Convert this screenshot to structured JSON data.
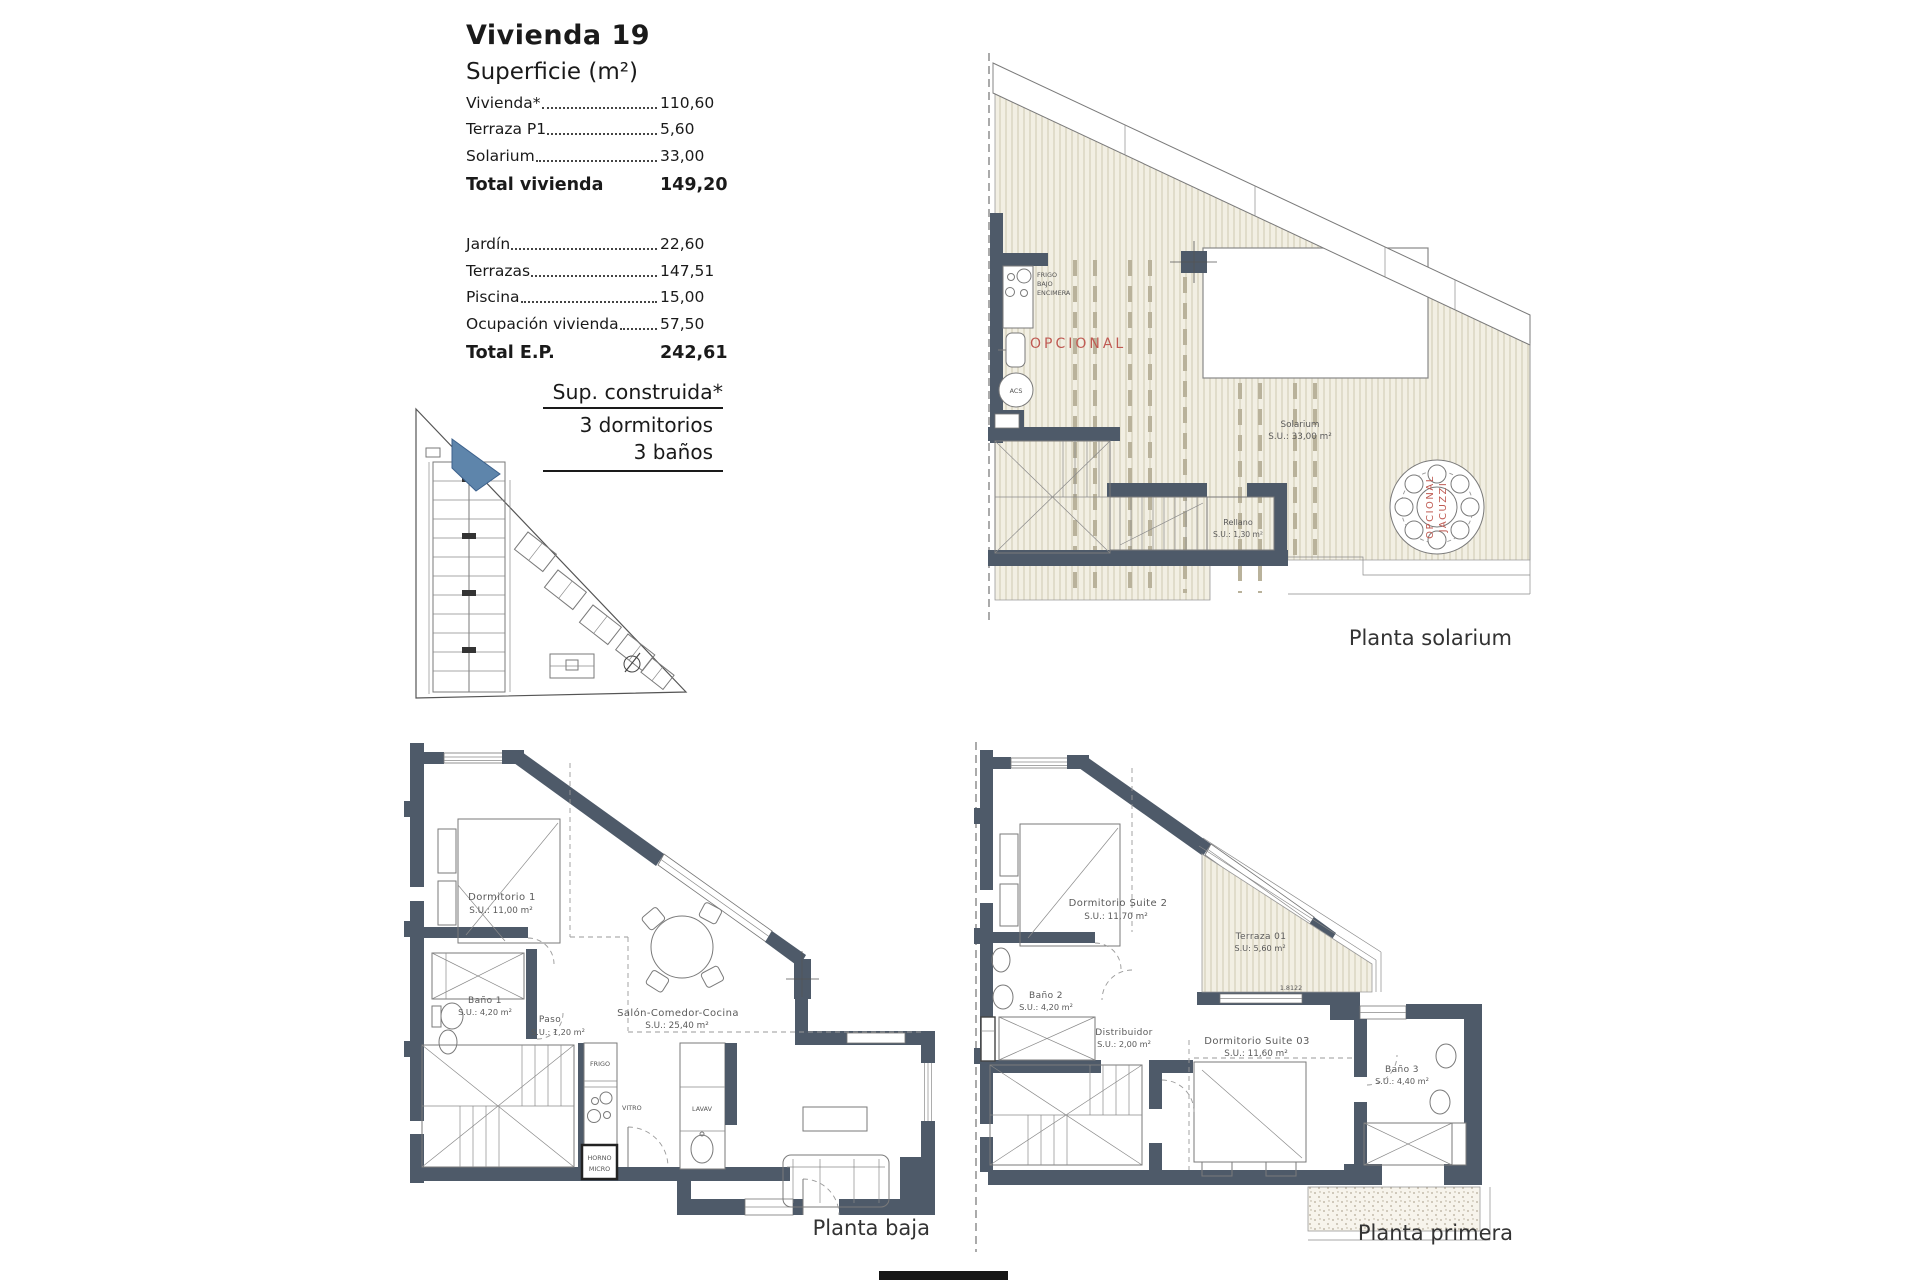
{
  "info_panel": {
    "title": "Vivienda 19",
    "subtitle": "Superficie (m²)",
    "rows": [
      {
        "label": "Vivienda*",
        "value": "110,60"
      },
      {
        "label": "Terraza P1",
        "value": "5,60"
      },
      {
        "label": "Solarium",
        "value": "33,00"
      }
    ],
    "total1": {
      "label": "Total vivienda",
      "value": "149,20"
    },
    "rows2": [
      {
        "label": "Jardín",
        "value": "22,60"
      },
      {
        "label": "Terrazas",
        "value": "147,51"
      },
      {
        "label": "Piscina",
        "value": "15,00"
      },
      {
        "label": "Ocupación vivienda",
        "value": "57,50"
      }
    ],
    "total2": {
      "label": "Total E.P.",
      "value": "242,61"
    },
    "built": {
      "line1": "Sup. construida*",
      "line2": "3 dormitorios",
      "line3": "3 baños"
    }
  },
  "colors": {
    "wall": "#4E5A69",
    "highlight_unit_blue": "#5E85AB",
    "optional_red": "#BF5A52",
    "pergola_hatch_bg": "#F2EFE3",
    "pergola_hatch_line": "#CFC8B2"
  },
  "plans": {
    "solarium": {
      "caption": "Planta solarium",
      "labels": {
        "counter1": "FRIGO",
        "counter2": "BAJO",
        "counter3": "ENCIMERA",
        "opcional": "OPCIONAL",
        "acs": "ACS",
        "rellano_name": "Rellano",
        "rellano_area": "S.U.: 1,30 m²",
        "solarium_name": "Solarium",
        "solarium_area": "S.U.: 33,00 m²",
        "jacuzzi1": "OPCIONAL",
        "jacuzzi2": "JACUZZI"
      }
    },
    "baja": {
      "caption": "Planta baja",
      "rooms": [
        {
          "name": "Dormitorio 1",
          "area": "S.U.: 11,00 m²"
        },
        {
          "name": "Baño 1",
          "area": "S.U.: 4,20 m²"
        },
        {
          "name": "Paso",
          "area": "S.U.: 1,20 m²"
        },
        {
          "name": "Salón-Comedor-Cocina",
          "area": "S.U.: 25,40 m²"
        }
      ],
      "appliances": {
        "frigo": "FRIGO",
        "vitro": "VITRO",
        "lavav": "LAVAV",
        "horno": "HORNO",
        "micro": "MICRO"
      }
    },
    "primera": {
      "caption": "Planta primera",
      "rooms": [
        {
          "name": "Dormitorio Suite 2",
          "area": "S.U.: 11,70 m²"
        },
        {
          "name": "Terraza 01",
          "area": "S.U: 5,60 m²"
        },
        {
          "name": "Baño 2",
          "area": "S.U.: 4,20 m²"
        },
        {
          "name": "Distribuidor",
          "area": "S.U.: 2,00 m²"
        },
        {
          "name": "Dormitorio Suite 03",
          "area": "S.U.: 11,60 m²"
        },
        {
          "name": "Baño 3",
          "area": "S.U.: 4,40 m²"
        }
      ],
      "dimension": "1.8122"
    }
  }
}
